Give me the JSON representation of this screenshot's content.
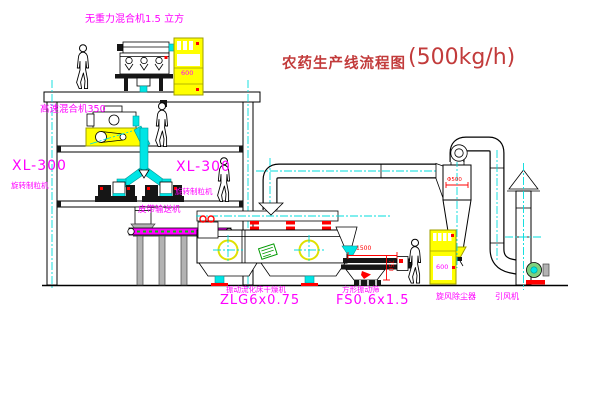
{
  "title": {
    "text": "农药生产线流程图",
    "capacity": "(500kg/h)"
  },
  "labels": {
    "gravity_mixer": "无重力混合机1.5 立方",
    "high_speed_mixer": "高速混合机350",
    "granulator_left_model": "XL-300",
    "granulator_left_name": "旋转制粒机",
    "granulator_right_model": "XL-300",
    "granulator_right_name": "旋转制粒机",
    "belt_conveyor": "皮带输送机",
    "dryer_name": "振动流化床干燥机",
    "dryer_model": "ZLG6x0.75",
    "sieve_name": "方形振动筛",
    "sieve_model": "FS0.6x1.5",
    "cyclone": "旋风除尘器",
    "fan": "引风机"
  },
  "cabinets": {
    "top_display": "600",
    "right_display": "600"
  },
  "dimensions": {
    "sieve_length": "1500",
    "sieve_height": "750",
    "cyclone_dia": "Φ500"
  },
  "colors": {
    "label_magenta": "#FF00FF",
    "title_red": "#C23B3B",
    "dimension_red": "#FF0000",
    "machine_yellow": "#FFFF00",
    "pipe_cyan": "#00E5E5",
    "line_black": "#000000"
  }
}
